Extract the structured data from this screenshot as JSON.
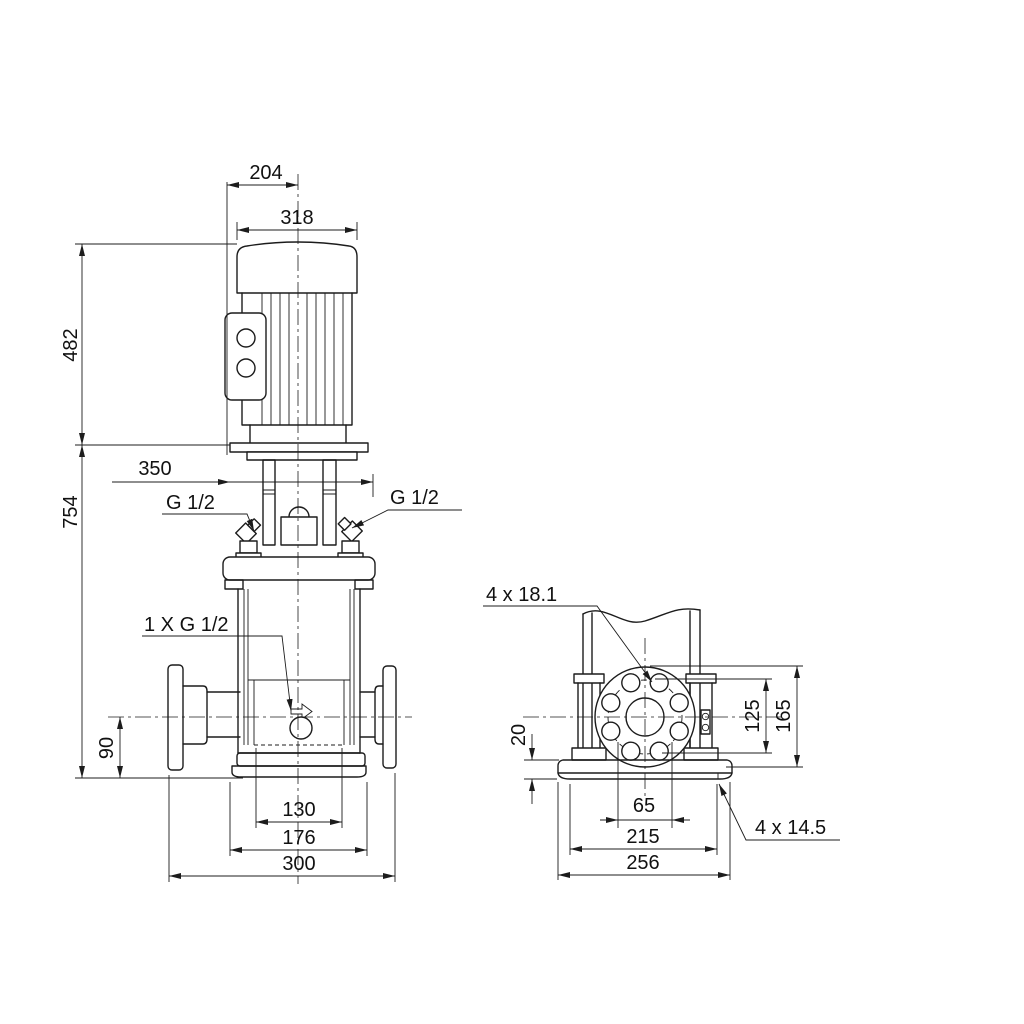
{
  "dimensions": {
    "motor_top_width": "204",
    "motor_width": "318",
    "motor_height": "482",
    "clearance_width": "350",
    "plug_left": "G 1/2",
    "plug_right": "G 1/2",
    "total_height": "754",
    "drain_port": "1 X G 1/2",
    "port_center_height": "90",
    "base_bolt_inner": "130",
    "base_mid_width": "176",
    "flange_span": "300",
    "flange_holes": "4 x 18.1",
    "base_plate_height": "20",
    "bolt_circle": "125",
    "flange_od": "165",
    "slot_spacing": "65",
    "base_hole_spacing": "215",
    "base_width": "256",
    "base_holes": "4 x 14.5"
  }
}
